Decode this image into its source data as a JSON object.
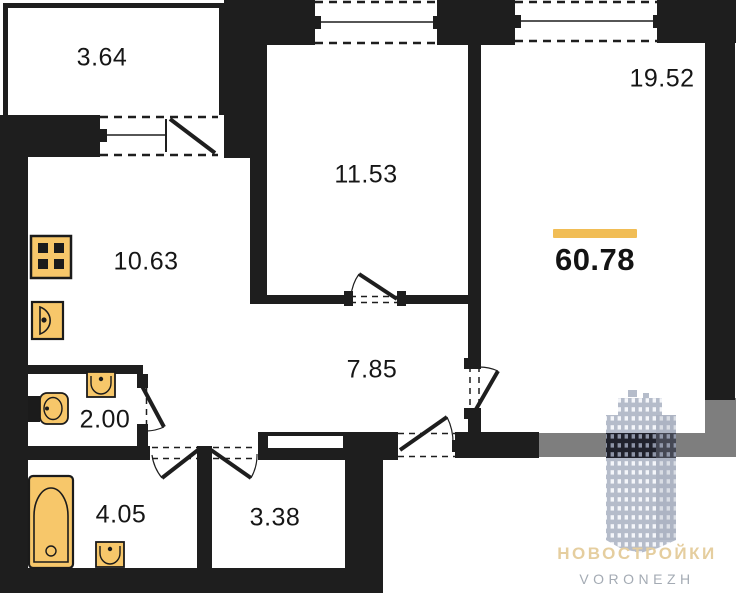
{
  "plan": {
    "title": "apartment floor plan",
    "total_area": "60.78",
    "rooms": [
      {
        "name": "balcony",
        "area": "3.64"
      },
      {
        "name": "kitchen",
        "area": "10.63"
      },
      {
        "name": "room-1",
        "area": "11.53"
      },
      {
        "name": "room-2",
        "area": "19.52"
      },
      {
        "name": "hallway",
        "area": "7.85"
      },
      {
        "name": "wc",
        "area": "2.00"
      },
      {
        "name": "bathroom",
        "area": "4.05"
      },
      {
        "name": "storage",
        "area": "3.38"
      }
    ],
    "icons": [
      "stove-icon",
      "kitchen-sink-icon",
      "toilet-icon",
      "washbasin-icon",
      "bathtub-icon",
      "window-icon",
      "door-swing-icon"
    ],
    "colors": {
      "wall": "#1e1e1e",
      "neighbor_wall_grey": "#7e7e7e",
      "fixture_yellow": "#F7C76A",
      "accent_bar": "#F1BD55",
      "watermark_gold": "#E5CE9F",
      "watermark_grey": "#A4ABB4",
      "building_light": "#b5bcca",
      "building_dark": "#20222c"
    }
  },
  "watermark": {
    "title": "НОВОСТРОЙКИ",
    "subtitle": "VORONEZH"
  }
}
